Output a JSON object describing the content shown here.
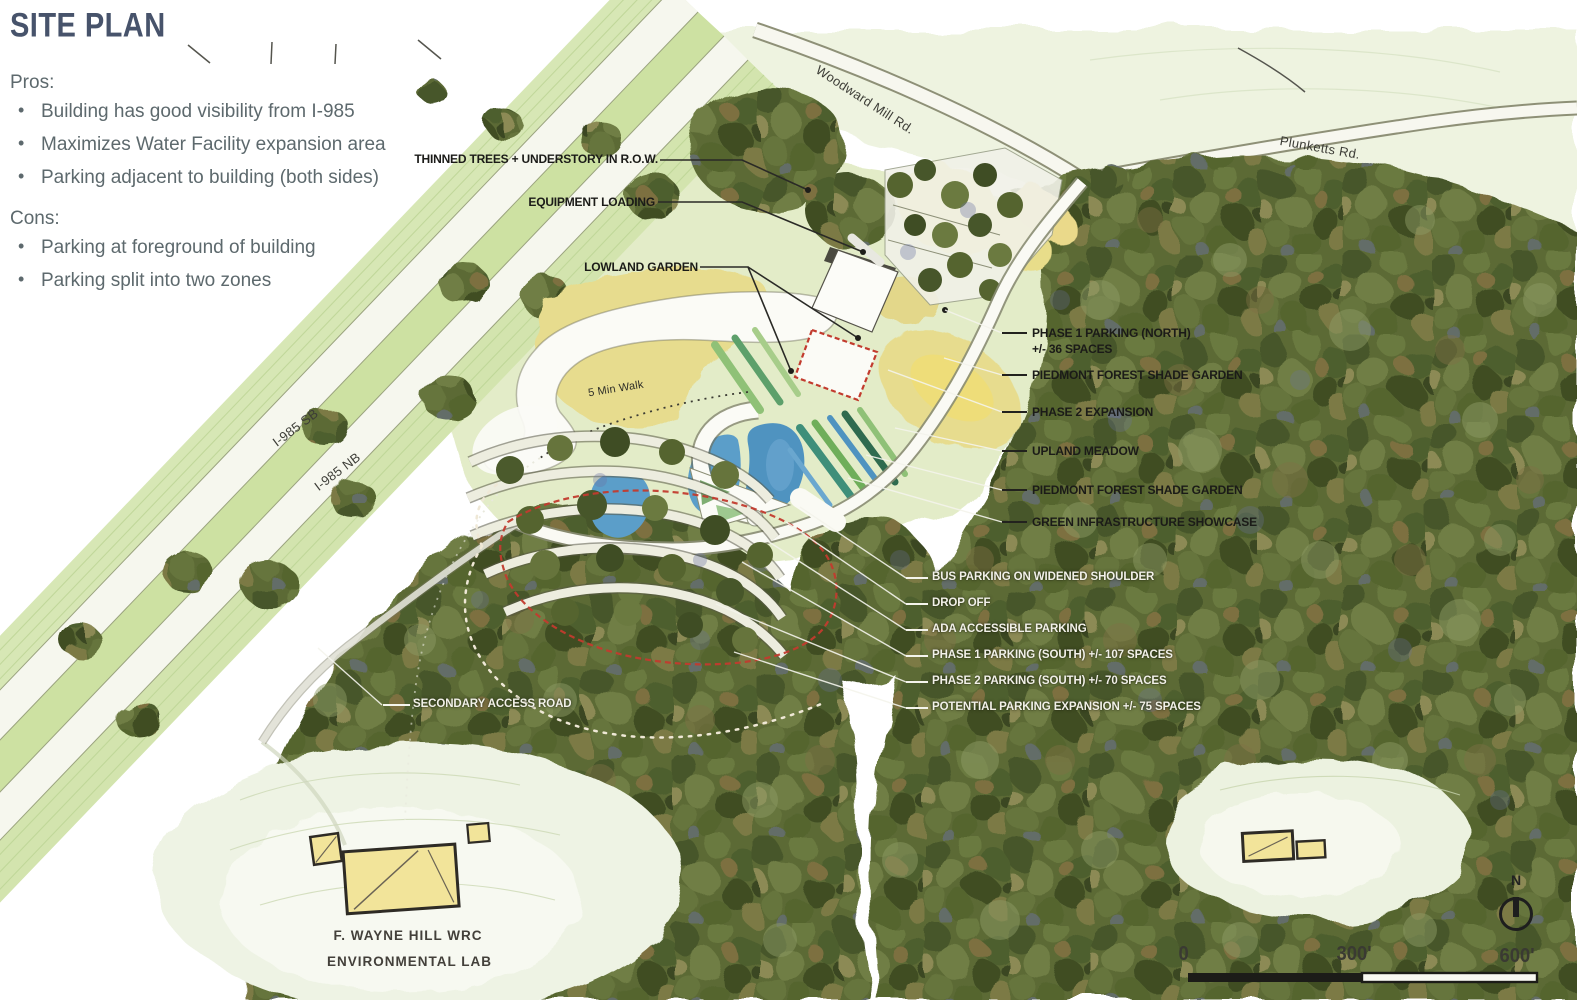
{
  "title": "SITE PLAN",
  "pros": {
    "heading": "Pros:",
    "items": [
      "Building has good visibility from I-985",
      "Maximizes Water Facility expansion area",
      "Parking adjacent to building (both sides)"
    ]
  },
  "cons": {
    "heading": "Cons:",
    "items": [
      "Parking at foreground of building",
      "Parking split into two zones"
    ]
  },
  "callouts": {
    "thinned_trees": "THINNED TREES + UNDERSTORY IN R.O.W.",
    "equipment_loading": "EQUIPMENT LOADING",
    "lowland_garden": "LOWLAND GARDEN",
    "phase1_north": "PHASE 1 PARKING (NORTH)",
    "phase1_north_spaces": "+/- 36 SPACES",
    "piedmont_1": "PIEDMONT FOREST SHADE GARDEN",
    "phase2_expansion": "PHASE 2 EXPANSION",
    "upland_meadow": "UPLAND MEADOW",
    "piedmont_2": "PIEDMONT FOREST SHADE GARDEN",
    "green_infrastructure": "GREEN INFRASTRUCTURE SHOWCASE",
    "bus_parking": "BUS PARKING ON WIDENED SHOULDER",
    "drop_off": "DROP OFF",
    "ada_parking": "ADA ACCESSIBLE PARKING",
    "phase1_south": "PHASE 1 PARKING (SOUTH) +/- 107 SPACES",
    "phase2_south": "PHASE 2 PARKING (SOUTH) +/- 70 SPACES",
    "potential_expansion": "POTENTIAL PARKING EXPANSION +/- 75 SPACES",
    "secondary_access": "SECONDARY ACCESS ROAD"
  },
  "roads": {
    "woodward_mill": "Woodward Mill Rd.",
    "plunketts": "Plunketts Rd.",
    "i985_sb": "I-985 SB",
    "i985_nb": "I-985 NB"
  },
  "annotations": {
    "walk": "5 Min Walk"
  },
  "facility": {
    "line1": "F. WAYNE HILL WRC",
    "line2": "ENVIRONMENTAL LAB"
  },
  "scale_bar": {
    "zero": "0",
    "mid": "300'",
    "end": "600'"
  },
  "compass": {
    "north": "N"
  },
  "colors": {
    "title": "#47536b",
    "list_text": "#5d696d",
    "callout_dark": "#1b1b18",
    "callout_light": "#f2f1e8",
    "red_dash": "#c23b2e",
    "pond_blue": "#4f93c0",
    "meadow_yellow": "#e7dc8e",
    "forest_green": "#5c6a35",
    "corridor_green": "#d7e7b5",
    "building_yellow": "#f2e49a"
  }
}
